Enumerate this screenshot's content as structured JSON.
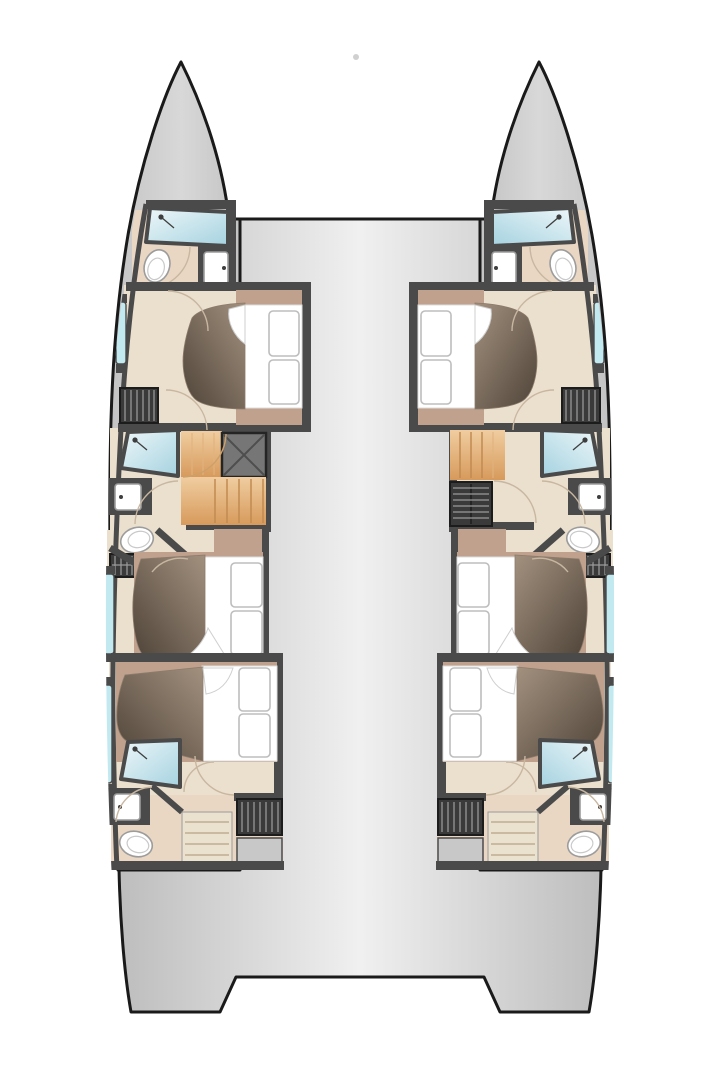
{
  "page": {
    "background": "#ffffff"
  },
  "diagram": {
    "title": "Catamaran yacht lower-deck floor plan, top view with bows up",
    "type": "boat-floorplan",
    "view": "top-down",
    "hull_count": 2,
    "cabin_count": 6,
    "bathroom_count": 6
  },
  "colors": {
    "outline": "#1a1a1a",
    "wall": "#4a4a4a",
    "hull_fill": "#c3c3c3",
    "hull_fill_light": "#d8d8d8",
    "deck_edge": "#bdbdbd",
    "deck_center": "#f0f0f0",
    "floor": "#ebdfcd",
    "floor_bath": "#e9d7c4",
    "bed_frame": "#bfa18d",
    "duvet_light": "#a3917f",
    "duvet_dark": "#4e4338",
    "linen": "#ffffff",
    "linen_outline": "#bdbdbd",
    "shower_light": "#eef7f9",
    "shower_dark": "#a5d2e0",
    "window_glass": "#c3e9f0",
    "wood_light": "#f0cda0",
    "wood_dark": "#d79a5c",
    "wood_tread": "#c18a50",
    "stair_cream": "#eae1cf",
    "stair_tread": "#bfae92",
    "hatch_dark": "#3a3a3a",
    "hatch_stripe": "#9a9a9a",
    "fixture_outline": "#9c9c9c",
    "door_arc": "#c8b7a0",
    "page_bg": "#ffffff"
  },
  "port_hull": {
    "label": "Port hull",
    "rooms": [
      {
        "id": "forward-bathroom",
        "label": "Forward bathroom",
        "features": [
          "shower",
          "toilet",
          "washbasin"
        ]
      },
      {
        "id": "forward-cabin",
        "label": "Forward double cabin",
        "features": [
          "double-bed",
          "wardrobe",
          "hull-window"
        ]
      },
      {
        "id": "mid-bathroom",
        "label": "Mid bathroom",
        "features": [
          "shower",
          "toilet",
          "washbasin",
          "locker-vent"
        ]
      },
      {
        "id": "mid-cabin",
        "label": "Mid double cabin",
        "features": [
          "double-bed",
          "hull-window"
        ]
      },
      {
        "id": "aft-cabin",
        "label": "Aft double cabin",
        "features": [
          "double-bed",
          "hull-window"
        ]
      },
      {
        "id": "aft-bathroom",
        "label": "Aft bathroom",
        "features": [
          "shower",
          "toilet",
          "washbasin"
        ]
      },
      {
        "id": "aft-companionway",
        "label": "Aft companionway stairs",
        "features": [
          "steps"
        ]
      },
      {
        "id": "engine-hatch",
        "label": "Engine hatch",
        "features": [
          "louvered-hatch"
        ]
      },
      {
        "id": "mid-companionway",
        "label": "Companionway stairs with deck hatch",
        "features": [
          "wood-steps",
          "deck-hatch"
        ]
      }
    ]
  },
  "starboard_hull": {
    "label": "Starboard hull",
    "mirror_of": "port_hull"
  },
  "deck": {
    "label": "Bridge deck and aft platform"
  },
  "markers": {
    "bow_dot": "anchor point between bows"
  }
}
